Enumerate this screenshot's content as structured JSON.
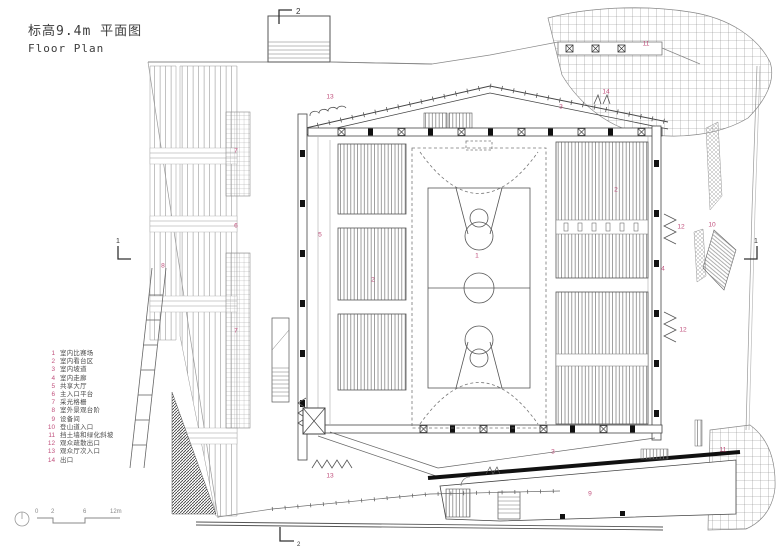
{
  "title": {
    "line_cn": "标高9.4m 平面图",
    "line_en": "Floor Plan"
  },
  "legend": {
    "items": [
      {
        "num": "1",
        "label": "室内比赛场"
      },
      {
        "num": "2",
        "label": "室内看台区"
      },
      {
        "num": "3",
        "label": "室内坡道"
      },
      {
        "num": "4",
        "label": "室内走廊"
      },
      {
        "num": "5",
        "label": "共享大厅"
      },
      {
        "num": "6",
        "label": "主入口平台"
      },
      {
        "num": "7",
        "label": "采光格栅"
      },
      {
        "num": "8",
        "label": "室外景观台阶"
      },
      {
        "num": "9",
        "label": "设备间"
      },
      {
        "num": "10",
        "label": "登山道入口"
      },
      {
        "num": "11",
        "label": "挡土墙和绿化斜坡"
      },
      {
        "num": "12",
        "label": "观众疏散出口"
      },
      {
        "num": "13",
        "label": "观众厅次入口"
      },
      {
        "num": "14",
        "label": "出口"
      }
    ]
  },
  "scale_bar": {
    "ticks": [
      "0",
      "2",
      "6",
      "12m"
    ]
  },
  "section_markers": {
    "top": "2",
    "bottom": "2",
    "left": "1",
    "right": "1"
  },
  "plan_labels": [
    {
      "text": "13"
    },
    {
      "text": "3"
    },
    {
      "text": "14"
    },
    {
      "text": "11"
    },
    {
      "text": "7"
    },
    {
      "text": "6"
    },
    {
      "text": "5"
    },
    {
      "text": "2"
    },
    {
      "text": "1"
    },
    {
      "text": "8"
    },
    {
      "text": "2"
    },
    {
      "text": "12"
    },
    {
      "text": "10"
    },
    {
      "text": "4"
    },
    {
      "text": "7"
    },
    {
      "text": "12"
    },
    {
      "text": "3"
    },
    {
      "text": "13"
    },
    {
      "text": "9"
    },
    {
      "text": "11"
    }
  ],
  "colors": {
    "label_red": "#c0507c",
    "line_dark": "#444444",
    "line_light": "#999999"
  }
}
